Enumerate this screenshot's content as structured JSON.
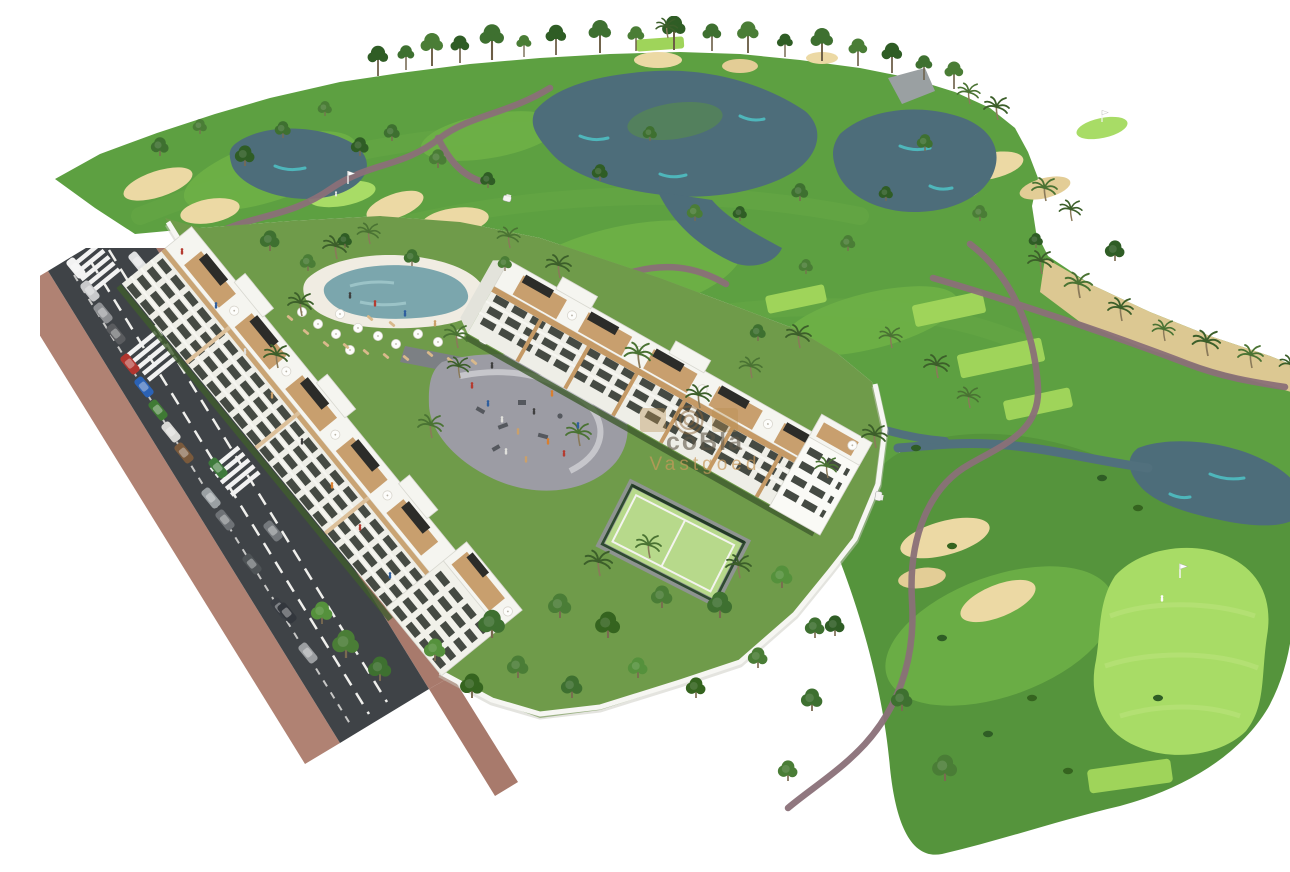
{
  "image": {
    "title": "Aerial 3D render of golf resort apartments",
    "description": "Bird's-eye architectural rendering: two white apartment buildings with roof terraces, a pool, playground plaza and padel court beside a golf course with lakes, sand bunkers, palm trees and a tree-lined access road with parked cars",
    "watermark": {
      "brand": "coBla",
      "word": "Vastgoed"
    },
    "palette": {
      "fairway": "#5da041",
      "fairway_dark": "#55943c",
      "tee_green": "#9fd45a",
      "green_light": "#a8dc66",
      "sand": "#ecd9a4",
      "sand_waste": "#dcc892",
      "water": "#4d6d7a",
      "water_highlight": "#4fc3c7",
      "path": "#8a7078",
      "asphalt": "#3f4347",
      "sidewalk": "#b08273",
      "building": "#fbfbf9",
      "wood": "#c89f6e",
      "court": "#b7d98b",
      "plaza": "#9c9ca4",
      "garden": "#6f9b4a"
    }
  }
}
